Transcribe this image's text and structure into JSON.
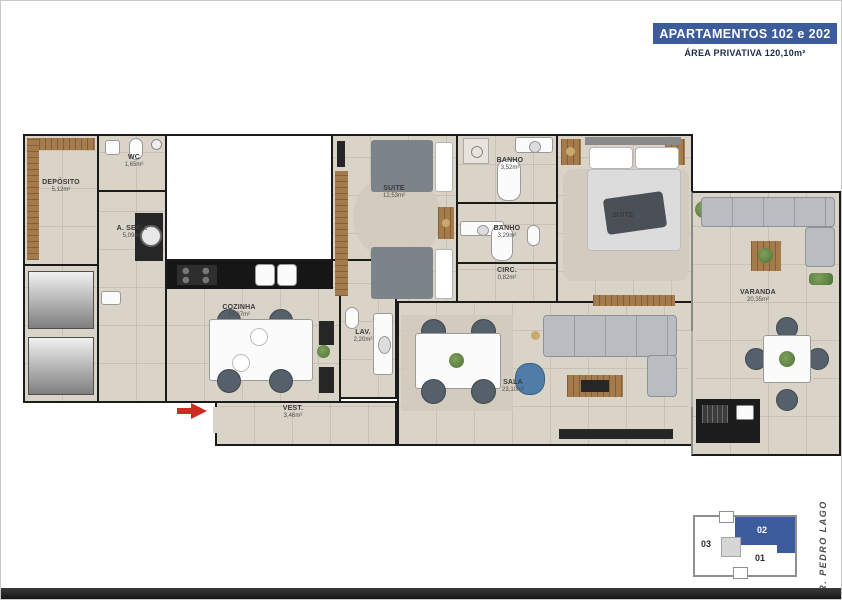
{
  "header": {
    "title": "APARTAMENTOS 102 e 202",
    "subtitle": "ÁREA PRIVATIVA 120,10m²"
  },
  "rooms": {
    "deposito": {
      "label": "DEPÓSITO",
      "area": "5,12m²"
    },
    "wc": {
      "label": "WC",
      "area": "1,65m²"
    },
    "aserv": {
      "label": "A. SERV.",
      "area": "5,09m²"
    },
    "suite1": {
      "label": "SUITE",
      "area": "12,53m²"
    },
    "banho1": {
      "label": "BANHO",
      "area": "3,52m²"
    },
    "banho2": {
      "label": "BANHO",
      "area": "3,29m²"
    },
    "circ": {
      "label": "CIRC.",
      "area": "0,82m²"
    },
    "suite2": {
      "label": "SUITE",
      "area": "15,78m²"
    },
    "cozinha": {
      "label": "COZINHA",
      "area": "13,37m²"
    },
    "lav": {
      "label": "LAV.",
      "area": "2,20m²"
    },
    "sala": {
      "label": "SALA",
      "area": "23,10m²"
    },
    "vest": {
      "label": "VEST.",
      "area": "3,46m²"
    },
    "varanda": {
      "label": "VARANDA",
      "area": "20,35m²"
    }
  },
  "keyplan": {
    "unit_02": "02",
    "unit_03": "03",
    "unit_01": "01",
    "street": "R. PEDRO LAGO",
    "highlighted_unit": "02"
  },
  "colors": {
    "accent_blue": "#3d5c9e",
    "wall": "#1b1b1b",
    "floor": "#d9d3c8",
    "arrow_red": "#cf2b20"
  }
}
